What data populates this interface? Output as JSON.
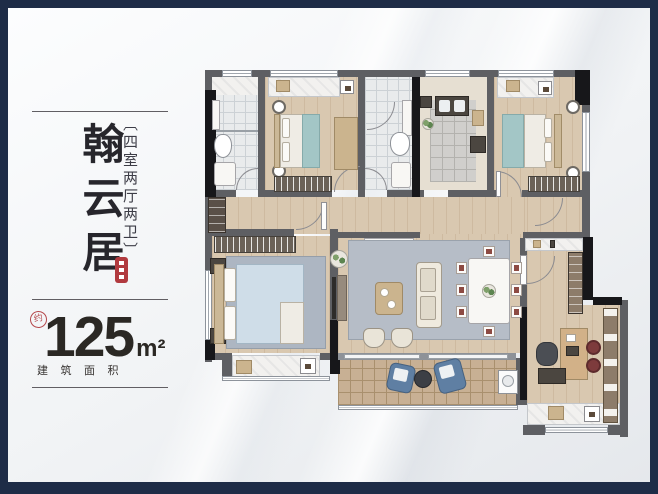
{
  "panel": {
    "title": "翰云居",
    "tagline_bracket_open": "〔",
    "tagline": "四室两厅两卫",
    "tagline_bracket_close": "〕",
    "approx_label": "约",
    "area_value": "125",
    "area_unit": "m²",
    "area_label": "建筑面积"
  },
  "palette": {
    "frame_navy": "#1e2c47",
    "seal_red": "#b13a3f",
    "wall_gray": "#5e5f63",
    "wall_black": "#17171a",
    "wood_floor": "#d9c8b0",
    "teal_bedding": "#a3c6c6",
    "master_bed_blue": "#cfdde8",
    "rug_gray": "#b6bdc7",
    "balcony_tile": "#c8b094",
    "pouf_red": "#7d3b3c",
    "beanbag_blue": "#5f7fa3"
  },
  "floor_plan": {
    "rooms": [
      "bathroom-1",
      "bedroom-2",
      "bathroom-2",
      "kitchen",
      "bedroom-3",
      "hallway",
      "master-bedroom",
      "living-dining",
      "entry",
      "study",
      "balcony"
    ]
  }
}
